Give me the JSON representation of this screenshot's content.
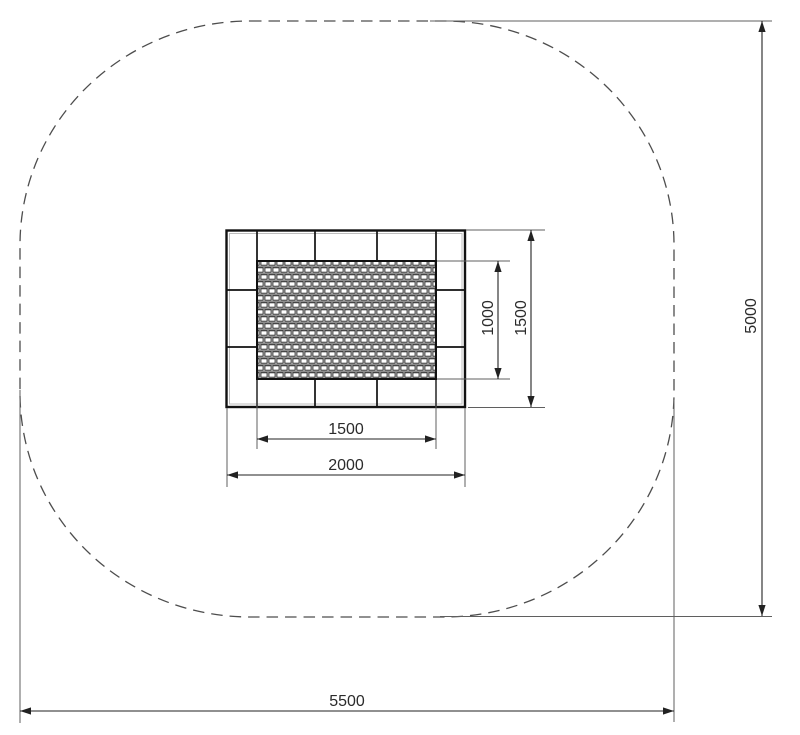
{
  "diagram": {
    "type": "technical-plan",
    "subject": "in-ground trampoline top view with safety clearance zone",
    "colors": {
      "background": "#ffffff",
      "frame_line": "#111111",
      "dashed_zone": "#4d4d4d",
      "dimension_line": "#222222"
    },
    "dimensions": {
      "mat_width": "1500",
      "mat_height": "1000",
      "frame_width": "2000",
      "frame_height": "1500",
      "safety_zone_width": "5500",
      "safety_zone_height": "5000"
    }
  }
}
